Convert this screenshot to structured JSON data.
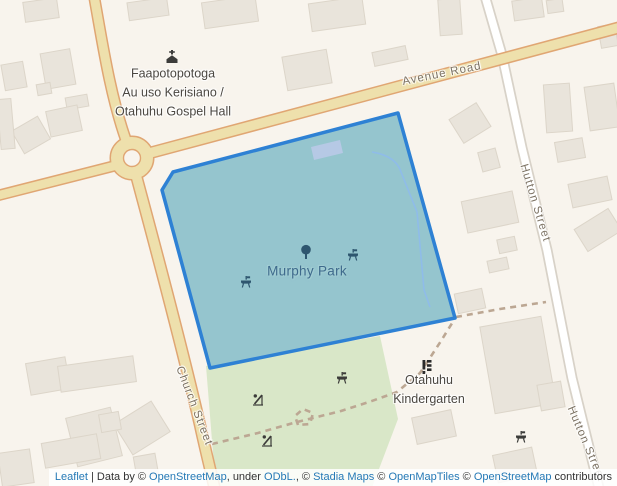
{
  "labels": {
    "gospel_hall": [
      "Faapotopotoga",
      "Au uso Kerisiano /",
      "Otahuhu Gospel Hall"
    ],
    "murphy_park": "Murphy Park",
    "kindergarten": [
      "Otahuhu",
      "Kindergarten"
    ],
    "avenue_road": "Avenue Road",
    "church_street": "Church Street",
    "hutton_street_upper": "Hutton Street",
    "hutton_street_lower": "Hutton Street"
  },
  "attribution": {
    "parts": [
      {
        "text": "Leaflet",
        "link": true,
        "name": "leaflet-link"
      },
      {
        "text": " | Data by © ",
        "link": false,
        "name": "attribution-text"
      },
      {
        "text": "OpenStreetMap",
        "link": true,
        "name": "openstreetmap-link"
      },
      {
        "text": ", under ",
        "link": false,
        "name": "attribution-text"
      },
      {
        "text": "ODbL.",
        "link": true,
        "name": "odbl-link"
      },
      {
        "text": ", © ",
        "link": false,
        "name": "attribution-text"
      },
      {
        "text": "Stadia Maps",
        "link": true,
        "name": "stadia-maps-link"
      },
      {
        "text": " © ",
        "link": false,
        "name": "attribution-text"
      },
      {
        "text": "OpenMapTiles",
        "link": true,
        "name": "openmaptiles-link"
      },
      {
        "text": " © ",
        "link": false,
        "name": "attribution-text"
      },
      {
        "text": "OpenStreetMap",
        "link": true,
        "name": "openstreetmap-contributors-link"
      },
      {
        "text": " contributors",
        "link": false,
        "name": "attribution-text"
      }
    ]
  },
  "colors": {
    "background": "#f8f4ed",
    "building": "#e9e4db",
    "building_stroke": "#dcd5c9",
    "road_yellow_fill": "#eee0ac",
    "road_yellow_casing": "#e0a673",
    "road_white_fill": "#ffffff",
    "road_white_casing": "#d8d2c8",
    "green": "#d9e7c8",
    "path_dash": "#bca793",
    "park_fill": "#95c5ce",
    "park_stroke": "#2e81d4",
    "park_building": "#b6c9e5",
    "park_path": "#8fbce9",
    "park_icon": "#2e566f",
    "dark_icon": "#3c3c3a",
    "poi_label": "#4b4741",
    "park_label": "#3e6a8c",
    "road_label": "#7c7263",
    "link": "#2579b6"
  },
  "map": {
    "green_areas": [
      "206,366 380,336 398,419 371,490 216,490"
    ],
    "buildings": [
      [
        41,
        10,
        34,
        20,
        -8
      ],
      [
        148,
        9,
        40,
        18,
        -8
      ],
      [
        58,
        69,
        30,
        36,
        -10
      ],
      [
        14,
        76,
        22,
        26,
        -10
      ],
      [
        44,
        89,
        14,
        11,
        -10
      ],
      [
        77,
        102,
        22,
        12,
        -10
      ],
      [
        64,
        121,
        32,
        26,
        -12
      ],
      [
        31,
        135,
        30,
        26,
        -30
      ],
      [
        6,
        124,
        14,
        50,
        -5
      ],
      [
        48,
        376,
        40,
        32,
        -10
      ],
      [
        97,
        374,
        76,
        26,
        -8
      ],
      [
        94,
        437,
        46,
        50,
        -14
      ],
      [
        142,
        428,
        44,
        36,
        -32
      ],
      [
        146,
        466,
        22,
        22,
        -10
      ],
      [
        16,
        468,
        32,
        34,
        -8
      ],
      [
        71,
        451,
        56,
        25,
        -10
      ],
      [
        110,
        422,
        20,
        18,
        -10
      ],
      [
        230,
        12,
        54,
        26,
        -8
      ],
      [
        307,
        70,
        45,
        34,
        -10
      ],
      [
        337,
        14,
        54,
        28,
        -8
      ],
      [
        390,
        56,
        34,
        14,
        -12
      ],
      [
        450,
        17,
        22,
        36,
        -4
      ],
      [
        528,
        9,
        30,
        20,
        -8
      ],
      [
        555,
        6,
        16,
        13,
        -8
      ],
      [
        608,
        36,
        17,
        22,
        -10
      ],
      [
        489,
        160,
        18,
        20,
        -15
      ],
      [
        490,
        212,
        52,
        32,
        -12
      ],
      [
        498,
        265,
        20,
        12,
        -12
      ],
      [
        507,
        245,
        18,
        14,
        -12
      ],
      [
        558,
        108,
        26,
        48,
        -4
      ],
      [
        602,
        107,
        30,
        44,
        -8
      ],
      [
        570,
        150,
        28,
        20,
        -10
      ],
      [
        590,
        192,
        40,
        24,
        -12
      ],
      [
        598,
        230,
        40,
        26,
        -32
      ],
      [
        470,
        123,
        32,
        28,
        -32
      ],
      [
        518,
        365,
        62,
        88,
        -10
      ],
      [
        515,
        465,
        40,
        28,
        -12
      ],
      [
        551,
        396,
        24,
        26,
        -10
      ],
      [
        470,
        301,
        28,
        20,
        -12
      ],
      [
        434,
        427,
        40,
        27,
        -12
      ]
    ],
    "roads_white": [
      {
        "name": "hutton-street-road",
        "d": "M 485,-4 L 502,55 L 522,148 L 547,250 L 572,378 L 600,492",
        "w": 7.5
      }
    ],
    "roads_yellow": [
      {
        "name": "church-street-north-road",
        "d": "M 94,-4 C 102,40 110,95 126,140",
        "w": 9
      },
      {
        "name": "church-street-south-road",
        "d": "M 136,175 C 152,235 178,330 200,425 C 205,448 210,468 215,490",
        "w": 9.5
      },
      {
        "name": "west-arm-road",
        "d": "M -4,196 L 114,166",
        "w": 8.5
      },
      {
        "name": "avenue-road-road",
        "d": "M 146,154 L 625,26",
        "w": 9.5
      }
    ],
    "roundabout": {
      "cx": 132,
      "cy": 158,
      "ring_r": 15,
      "ring_w": 12,
      "hole_r": 8.5
    },
    "dashed_paths": [
      "M 212,444 L 258,433 L 297,422 L 341,411 L 369,402 L 397,392 L 420,373 L 441,341 L 454,320",
      "M 456,317 L 500,309 L 546,302",
      "M 298,425 L 295,416 L 303,409 L 313,413 L 310,424 Z"
    ],
    "park": {
      "points": "398,113 173,172 162,190 210,368 455,318",
      "inner_building": "311,147 340,140 343,153 314,160",
      "inner_path": "M 372,152 Q 396,156 401,172 L 417,212 L 424,290 L 430,307"
    }
  }
}
